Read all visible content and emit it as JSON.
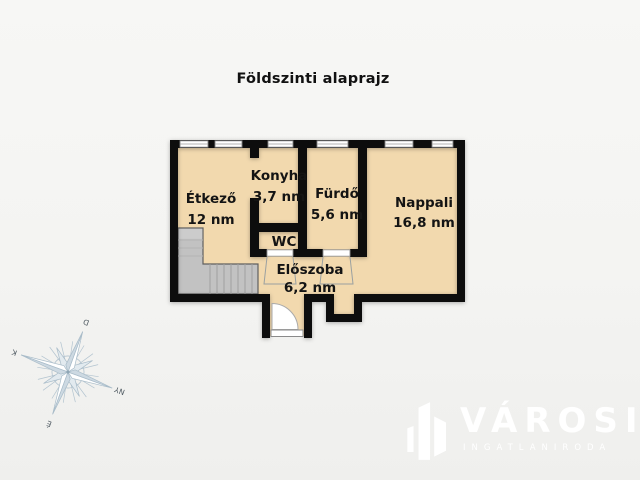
{
  "title": "Földszinti alaprajz",
  "rooms": [
    {
      "name": "Étkező",
      "area": "12 nm"
    },
    {
      "name": "Konyha",
      "area": "3,7 nm"
    },
    {
      "name": "Fürdő",
      "area": "5,6 nm"
    },
    {
      "name": "Nappali",
      "area": "16,8 nm"
    },
    {
      "name": "WC",
      "area": ""
    },
    {
      "name": "Előszoba",
      "area": "6,2 nm"
    }
  ],
  "compass": {
    "north": "É",
    "south": "D",
    "east": "K",
    "west": "NY"
  },
  "logo": {
    "name": "VÁROSI",
    "subtitle": "INGATLANIRODA"
  },
  "colors": {
    "background": "#f4f4f2",
    "floor": "#f2d9ae",
    "wall": "#0c0c0c",
    "stairs": "#c2c2c2",
    "window": "#ffffff",
    "compass_lines": "#a9bcc9",
    "logo": "#ffffff"
  }
}
